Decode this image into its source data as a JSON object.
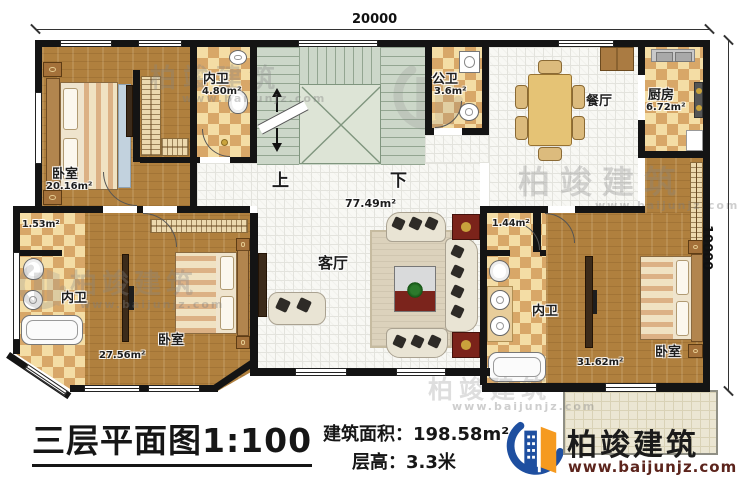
{
  "dimensions": {
    "top": "20000",
    "right": "10000"
  },
  "rooms": {
    "bedroom_tl": {
      "name": "卧室",
      "area": "20.16m²"
    },
    "bath_tl": {
      "name": "内卫",
      "area": "4.80m²"
    },
    "public_bath": {
      "name": "公卫",
      "area": "3.6m²"
    },
    "dining": {
      "name": "餐厅"
    },
    "kitchen": {
      "name": "厨房",
      "area": "6.72m²"
    },
    "living": {
      "name": "客厅",
      "area": "77.49m²"
    },
    "closet_left": {
      "area": "1.53m²"
    },
    "bath_left": {
      "name": "内卫"
    },
    "bedroom_bl": {
      "name": "卧室",
      "area": "27.56m²"
    },
    "bath_right": {
      "name": "内卫",
      "area": "1.44m²"
    },
    "bedroom_br": {
      "name": "卧室",
      "area": "31.62m²"
    }
  },
  "stairs": {
    "up": "上",
    "down": "下"
  },
  "titleblock": {
    "title": "三层平面图1:100",
    "area_label": "建筑面积：",
    "area_value": "198.58m²",
    "height_label": "层高：",
    "height_value": "3.3米"
  },
  "logo": {
    "name": "柏竣建筑",
    "url": "www.baijunjz.com"
  },
  "watermark": {
    "text": "柏竣建筑",
    "url": "www.baijunjz.com"
  },
  "colors": {
    "wall": "#141414",
    "wood": "#b0803e",
    "checker_dark": "#d8a768",
    "checker_light": "#f4dda5",
    "stair": "#ccd7c9",
    "tile": "#f8f8f4",
    "logo_blue": "#1e4fa0",
    "logo_orange": "#f59a20"
  }
}
